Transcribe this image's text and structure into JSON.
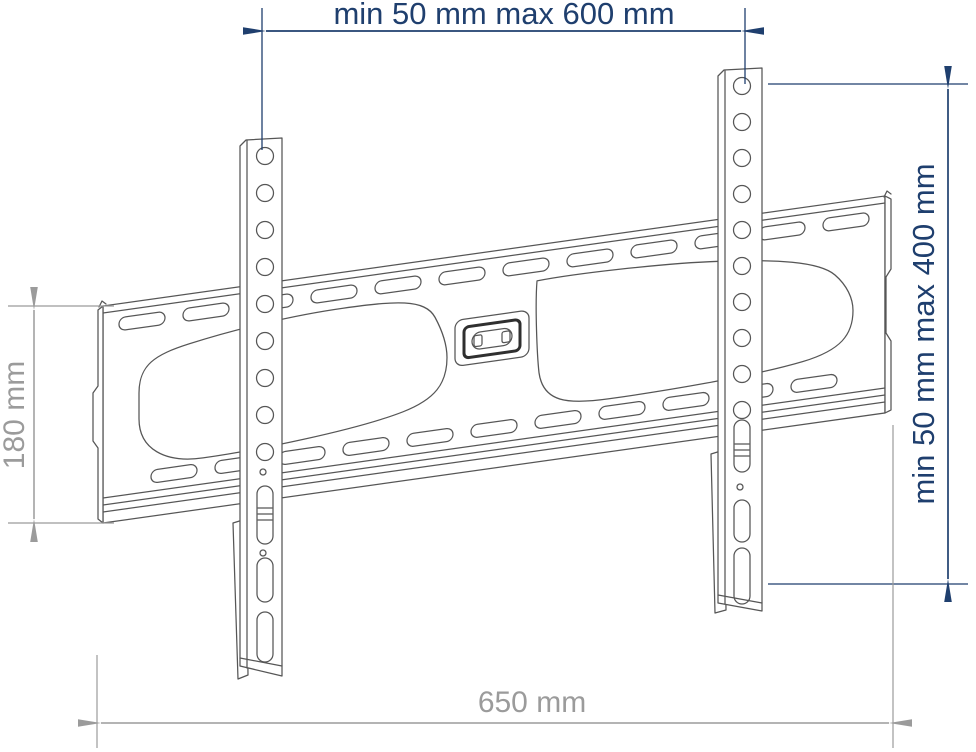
{
  "colors": {
    "dimension_blue": "#1f3f6e",
    "dimension_gray": "#9b9b9b",
    "drawing_line": "#565656"
  },
  "dimensions": {
    "top": "min 50 mm max 600 mm",
    "right": "min 50 mm max 400 mm",
    "left": "180 mm",
    "bottom": "650 mm"
  }
}
